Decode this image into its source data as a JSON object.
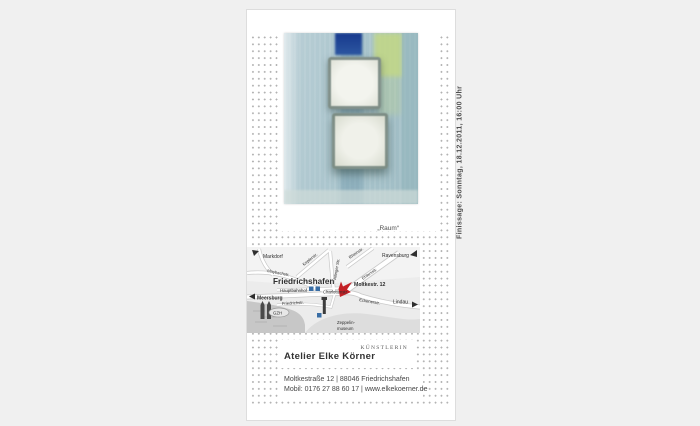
{
  "event": {
    "finissage": "Finissage: Sonntag, 18.12.2011, 16:00 Uhr",
    "artwork_caption": "„Raum“"
  },
  "artist": {
    "name": "Atelier  Elke Körner",
    "role": "KÜNSTLERIN"
  },
  "contact": {
    "address": "Moltkestraße 12 | 88046 Friedrichshafen",
    "mobile_web": "Mobil: 0176 27 88 60 17 | www.elkekoerner.de"
  },
  "map": {
    "city": "Friedrichshafen",
    "marker_label": "Moltkestr. 12",
    "labels": {
      "markdorf": "Markdorf",
      "ravensburg": "Ravensburg",
      "meersburg": "Meersburg",
      "lindau": "Lindau",
      "hauptbahnhof": "Hauptbahnhof",
      "maybachstr": "Maybachstr.",
      "keplerstr": "Keplerstr.",
      "ailingerstr": "Ailinger Str.",
      "rheinstr": "Rheinstr.",
      "ehlersstr": "Ehlersstr.",
      "charlottenstr": "Charlottenstr.",
      "friedrichstr": "Friedrichstr.",
      "eckenerstr": "Eckenerstr.",
      "gzh": "GZH",
      "zeppelin1": "Zeppelin-",
      "zeppelin2": "museum"
    }
  },
  "colors": {
    "marker_red": "#c32026",
    "station_blue": "#3a6ea5",
    "water_gray": "#c7c7c7"
  }
}
